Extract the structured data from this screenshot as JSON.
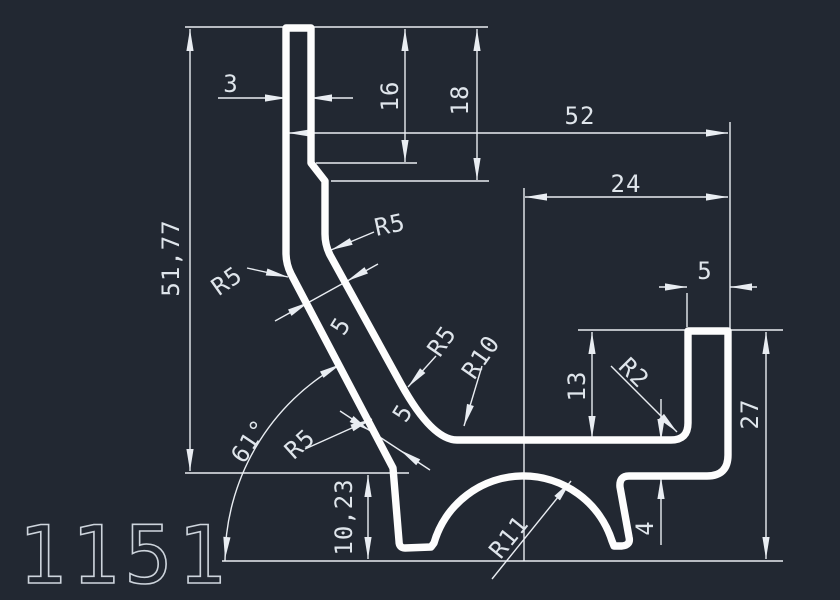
{
  "app": "cad-drawing-view",
  "part_number": "1151",
  "colors": {
    "background": "#222832",
    "profile_stroke": "#fdfdfd",
    "dimension_stroke": "#e9edf2",
    "text_color": "#dfe5eb"
  },
  "labels": {
    "wall_thickness_top": "3",
    "tube_depth_inner": "16",
    "tube_depth_outer": "18",
    "overall_width": "52",
    "channel_center_offset": "24",
    "upper_height": "51,77",
    "lip_width": "5",
    "radius_left_bend": "R5",
    "radius_right_bend": "R5",
    "wall_thickness_mid": "5",
    "radius_mid": "R5",
    "radius_lower_bend": "R10",
    "channel_inner_depth": "13",
    "radius_inner_corner": "R2",
    "channel_height": "27",
    "wall_thickness_diag": "5",
    "radius_diag": "R5",
    "draft_angle": "61°",
    "lower_height": "10,23",
    "wall_thickness_bottom": "4",
    "arch_radius": "R11"
  }
}
